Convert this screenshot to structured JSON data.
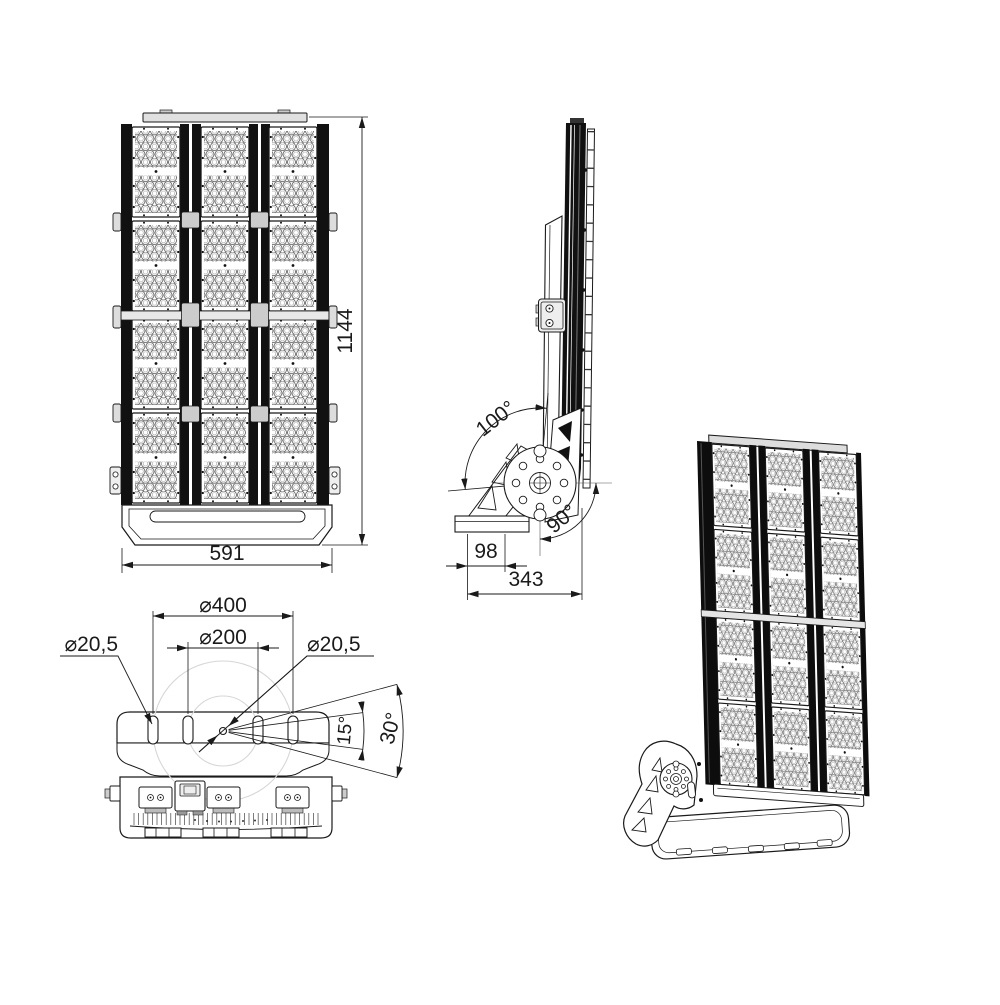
{
  "drawing": {
    "colors": {
      "line": "#1a1a1a",
      "dark": "#111111",
      "ghost": "#d6d6d6",
      "fill": "#ffffff"
    },
    "views": {
      "front": {
        "height": "1144",
        "width": "591"
      },
      "side": {
        "tilt_range": "100°",
        "swivel_range": "90°",
        "foot_width": "98",
        "depth": "343"
      },
      "top": {
        "outer_bolt_circle": "⌀400",
        "inner_bolt_circle": "⌀200",
        "slot_diameter_left": "⌀20,5",
        "center_hole_diameter": "⌀20,5",
        "step_angle": "15°",
        "range_angle": "30°"
      }
    }
  }
}
